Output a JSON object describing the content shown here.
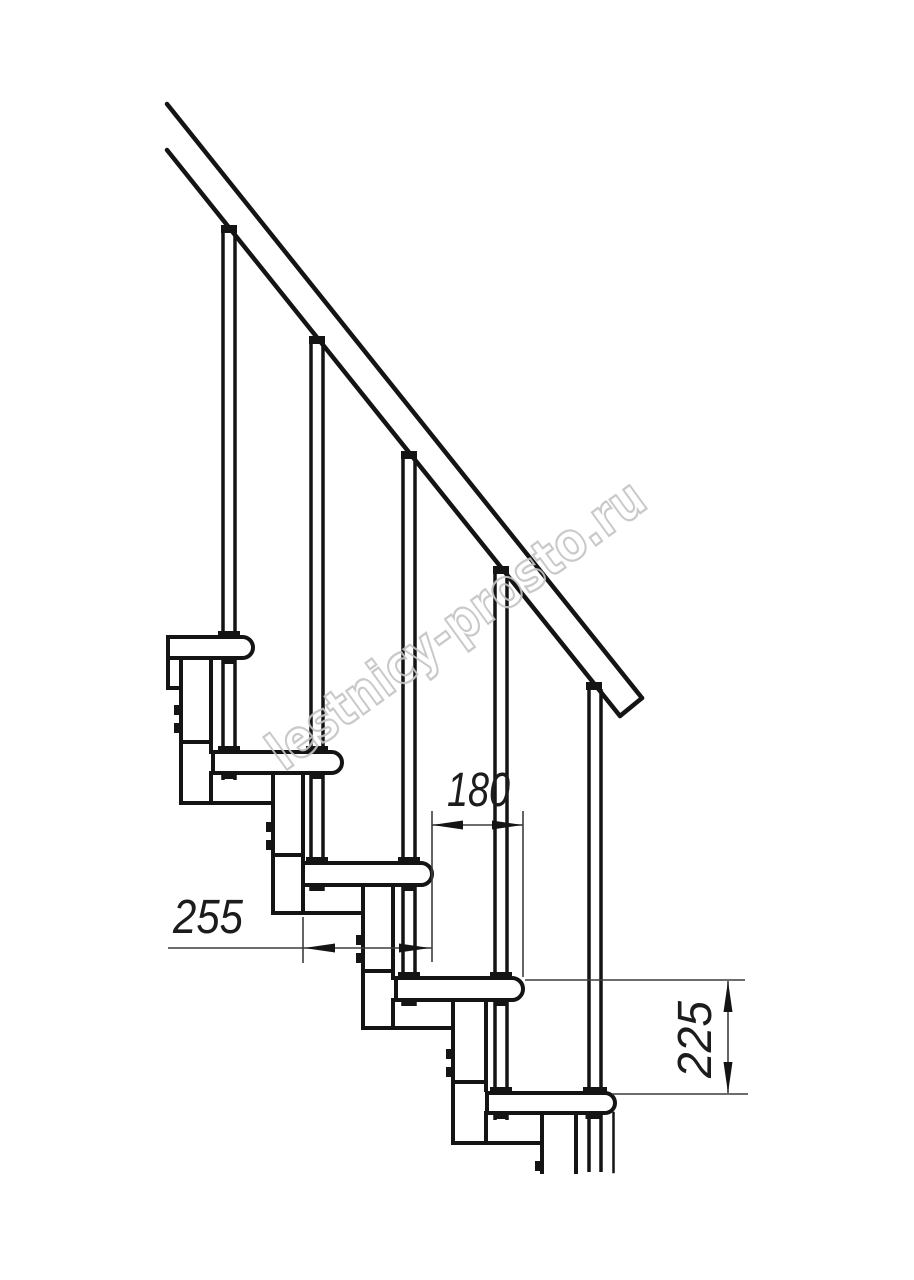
{
  "drawing": {
    "watermark": "lestnicy-prosto.ru",
    "dimensions": {
      "tread_depth": "255",
      "step_going": "180",
      "step_rise": "225"
    },
    "colors": {
      "line": "#141414",
      "dimension_line": "#3d3d3d",
      "watermark": "#c4c4c4",
      "background": "#ffffff"
    }
  }
}
